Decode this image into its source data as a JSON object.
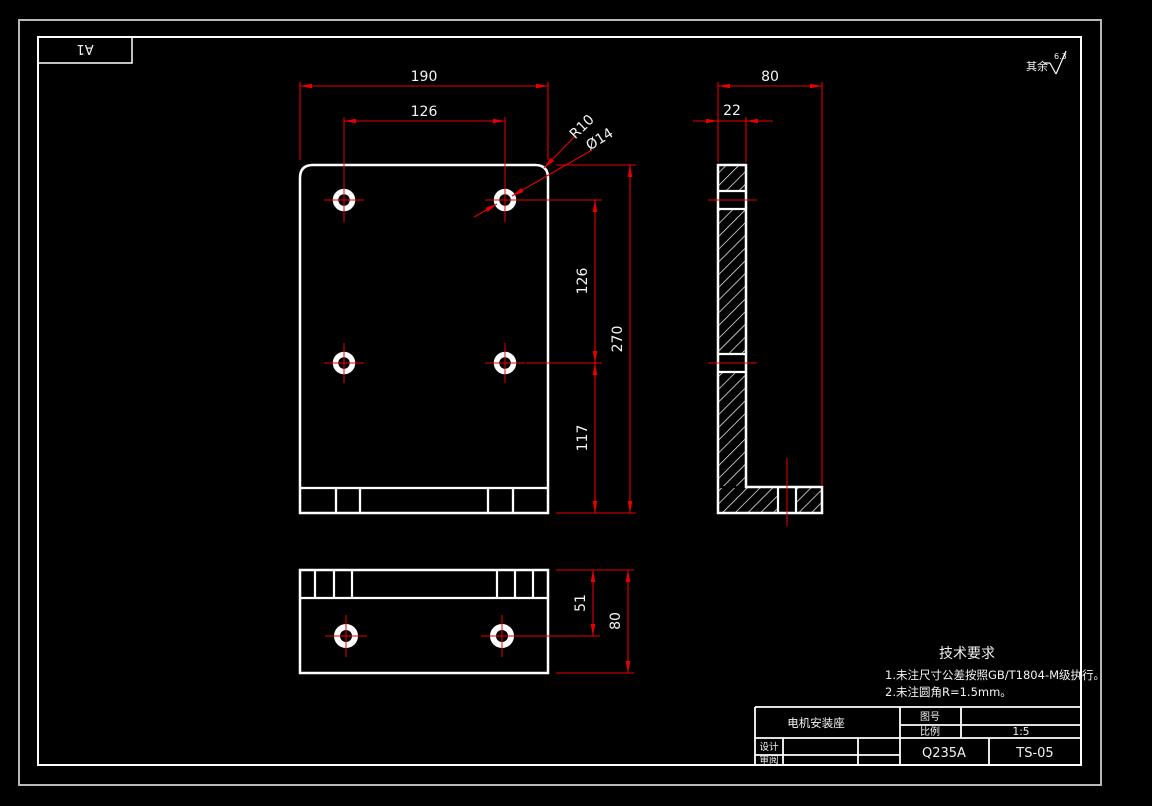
{
  "paper": {
    "size_label": "A1"
  },
  "surface_note": {
    "prefix": "其余",
    "roughness": "6.3"
  },
  "views": {
    "front": {
      "dim_width": "190",
      "dim_hole_spacing_x": "126",
      "dim_corner_radius": "R10",
      "dim_hole_diameter": "Ø14",
      "dim_hole_spacing_y": "126",
      "dim_height": "270",
      "dim_hole_to_bottom": "117"
    },
    "side": {
      "dim_depth": "80",
      "dim_thickness": "22"
    },
    "bottom": {
      "dim_hole_offset": "51",
      "dim_depth": "80"
    }
  },
  "tech_requirements": {
    "title": "技术要求",
    "items": [
      "1.未注尺寸公差按照GB/T1804-M级执行。",
      "2.未注圆角R=1.5mm。"
    ]
  },
  "title_block": {
    "part_name": "电机安装座",
    "drawing_no_label": "图号",
    "drawing_no_value": "",
    "scale_label": "比例",
    "scale_value": "1:5",
    "designer_label": "设计",
    "reviewer_label": "审阅",
    "material": "Q235A",
    "drawing_code": "TS-05"
  },
  "colors": {
    "dimension_red": "#e80000",
    "geometry_white": "#ffffff",
    "paper_label_green": "#00c800",
    "background": "#000000"
  }
}
